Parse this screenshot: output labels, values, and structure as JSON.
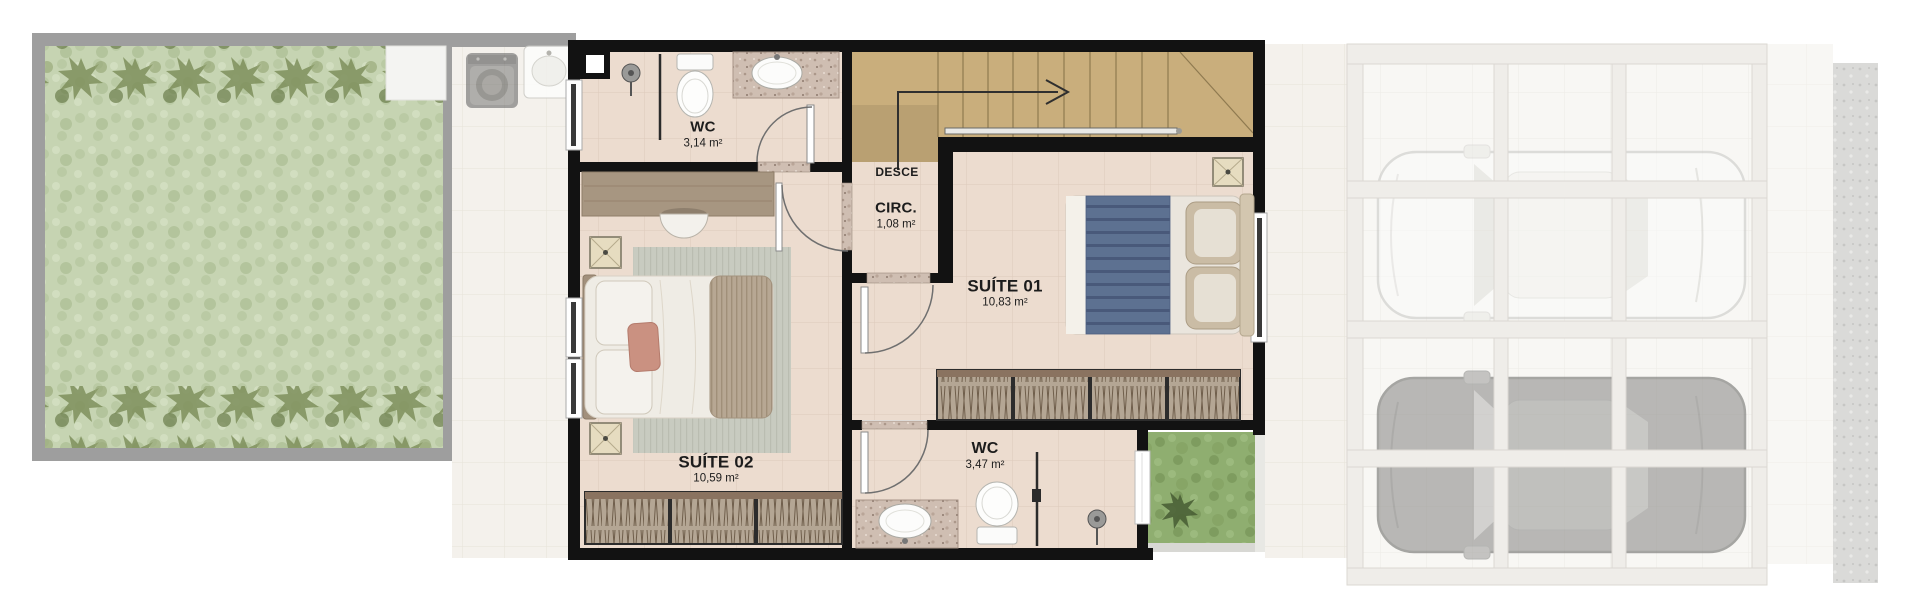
{
  "rooms": {
    "wc_top": {
      "name": "WC",
      "area": "3,14 m²"
    },
    "circulation": {
      "name": "CIRC.",
      "area": "1,08 m²"
    },
    "suite01": {
      "name": "SUÍTE 01",
      "area": "10,83 m²"
    },
    "suite02": {
      "name": "SUÍTE 02",
      "area": "10,59 m²"
    },
    "wc_bottom": {
      "name": "WC",
      "area": "3,47 m²"
    }
  },
  "stairs": {
    "label": "DESCE"
  },
  "colors": {
    "wall": "#121212",
    "room_floor": "#ecdccf",
    "stair_wood": "#c9ae7c",
    "wardrobe": "#b4a694",
    "blanket_blue": "#5d7191",
    "accent_pillow": "#ca9181",
    "grass_bright": "#8fae70",
    "grass_ghost": "#c6d4b2",
    "granite": "#cfbeb2"
  }
}
